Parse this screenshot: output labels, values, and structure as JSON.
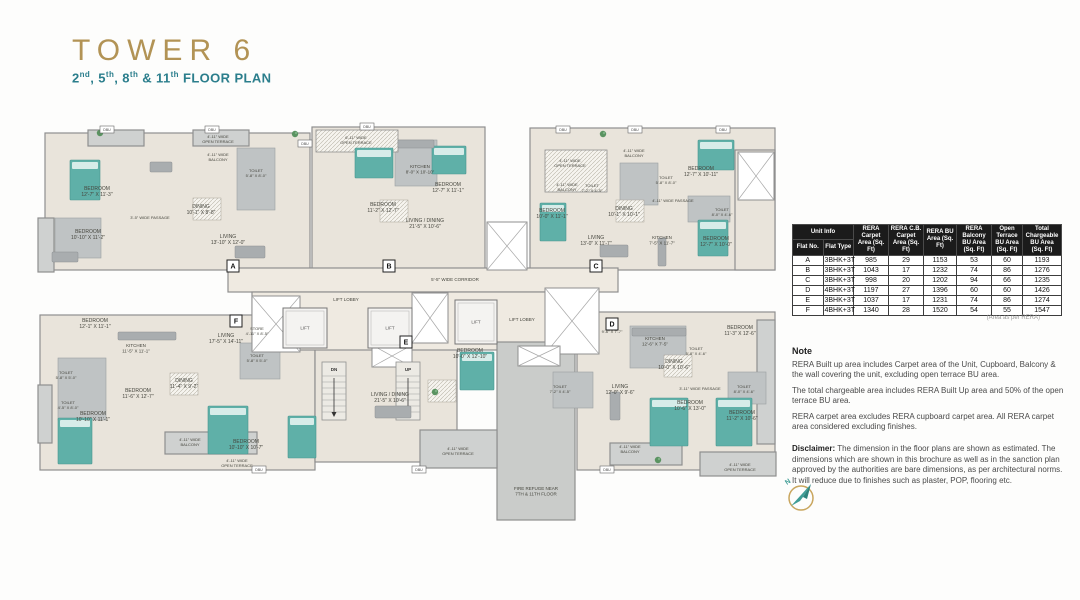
{
  "header": {
    "title": "TOWER 6",
    "subtitle_parts": [
      [
        "2",
        "nd"
      ],
      [
        ", 5",
        "th"
      ],
      [
        ", 8",
        "th"
      ],
      [
        " & 11",
        "th"
      ],
      [
        " FLOOR PLAN",
        ""
      ]
    ],
    "title_color": "#b29355",
    "subtitle_color": "#2b7e8c"
  },
  "table": {
    "group_header": "Unit Info",
    "header_bg": "#1b1b1b",
    "columns": [
      "Flat No.",
      "Flat Type",
      "RERA Carpet Area (Sq. Ft)",
      "RERA C.B. Carpet Area (Sq. Ft)",
      "RERA BU Area (Sq. Ft)",
      "RERA Balcony BU Area (Sq. Ft)",
      "Open Terrace BU Area (Sq. Ft)",
      "Total Chargeable BU Area (Sq. Ft)"
    ],
    "col_widths": [
      16,
      42,
      32,
      32,
      30,
      32,
      28,
      36
    ],
    "rows": [
      [
        "A",
        "3BHK+3T",
        "985",
        "29",
        "1153",
        "53",
        "60",
        "1193"
      ],
      [
        "B",
        "3BHK+3T",
        "1043",
        "17",
        "1232",
        "74",
        "86",
        "1276"
      ],
      [
        "C",
        "3BHK+3T",
        "998",
        "20",
        "1202",
        "94",
        "66",
        "1235"
      ],
      [
        "D",
        "4BHK+3T",
        "1197",
        "27",
        "1396",
        "60",
        "60",
        "1426"
      ],
      [
        "E",
        "3BHK+3T",
        "1037",
        "17",
        "1231",
        "74",
        "86",
        "1274"
      ],
      [
        "F",
        "4BHK+3T",
        "1340",
        "28",
        "1520",
        "54",
        "55",
        "1547"
      ]
    ],
    "caption": "(Area as per RERA)"
  },
  "notes": {
    "heading": "Note",
    "paragraphs": [
      "RERA Built up area includes Carpet area of the Unit, Cupboard, Balcony & the wall covering the unit, excluding open terrace BU area.",
      "The total chargeable area includes RERA Built Up area and 50% of the open terrace BU area.",
      "RERA carpet area excludes RERA cupboard carpet area. All RERA carpet area considered excluding finishes."
    ],
    "disclaimer_label": "Disclaimer:",
    "disclaimer_text": " The dimension in the floor plans are shown as estimated. The dimensions which are shown in this brochure as well as in the sanction plan approved by the authorities are bare dimensions, as per architectural norms. It will reduce due to finishes such as plaster, POP, flooring etc."
  },
  "compass": {
    "label": "N",
    "ring_color": "#c9a65e",
    "arrow_color": "#3f9d96"
  },
  "plan": {
    "colors": {
      "floor": "#e9e4db",
      "floor2": "#efeae1",
      "gray": "#cfd1d0",
      "tile": "#bfc3c4",
      "refuge": "#caccca",
      "wall": "#8f8f8f",
      "bed": "#5fb0a8",
      "pillow": "#d7ece9",
      "furn": "#a9adaf",
      "label": "#45453d",
      "plant": "#5a9361"
    },
    "blocks": [
      [
        45,
        133,
        265,
        137,
        "floor"
      ],
      [
        312,
        127,
        173,
        143,
        "floor"
      ],
      [
        530,
        128,
        245,
        142,
        "floor"
      ],
      [
        735,
        150,
        40,
        120,
        "floor"
      ],
      [
        40,
        315,
        275,
        155,
        "floor"
      ],
      [
        315,
        330,
        142,
        132,
        "floor"
      ],
      [
        577,
        312,
        198,
        158,
        "floor"
      ],
      [
        228,
        268,
        390,
        24,
        "floor2"
      ],
      [
        252,
        292,
        330,
        58,
        "floor2"
      ],
      [
        497,
        342,
        78,
        178,
        "refuge"
      ],
      [
        700,
        452,
        76,
        24,
        "gray"
      ],
      [
        610,
        443,
        72,
        22,
        "gray"
      ],
      [
        165,
        432,
        92,
        22,
        "gray"
      ],
      [
        420,
        430,
        77,
        38,
        "gray"
      ],
      [
        38,
        218,
        16,
        54,
        "gray"
      ],
      [
        38,
        385,
        14,
        58,
        "gray"
      ],
      [
        88,
        130,
        56,
        16,
        "gray"
      ],
      [
        193,
        130,
        56,
        16,
        "gray"
      ],
      [
        757,
        320,
        18,
        124,
        "gray"
      ]
    ],
    "tiles": [
      [
        237,
        148,
        38,
        62
      ],
      [
        55,
        218,
        46,
        40
      ],
      [
        395,
        140,
        42,
        46
      ],
      [
        620,
        163,
        38,
        42
      ],
      [
        688,
        196,
        42,
        26
      ],
      [
        58,
        358,
        48,
        62
      ],
      [
        240,
        343,
        40,
        36
      ],
      [
        630,
        326,
        56,
        42
      ],
      [
        728,
        372,
        38,
        32
      ],
      [
        553,
        372,
        40,
        36
      ]
    ],
    "hatches": [
      [
        316,
        130,
        82,
        22
      ],
      [
        545,
        150,
        62,
        42
      ]
    ],
    "shafts": [
      [
        487,
        222,
        40,
        48
      ],
      [
        545,
        288,
        54,
        66
      ],
      [
        252,
        296,
        48,
        56
      ],
      [
        412,
        293,
        36,
        50
      ],
      [
        372,
        345,
        40,
        22
      ],
      [
        518,
        346,
        42,
        20
      ],
      [
        738,
        152,
        36,
        48
      ]
    ],
    "lifts": [
      [
        283,
        308,
        44,
        40
      ],
      [
        368,
        308,
        44,
        40
      ],
      [
        455,
        300,
        42,
        44
      ]
    ],
    "lift_label": "LIFT",
    "stairs": [
      {
        "x": 322,
        "y": 362,
        "w": 24,
        "h": 58,
        "label": "DN"
      },
      {
        "x": 396,
        "y": 362,
        "w": 24,
        "h": 58,
        "label": "UP"
      }
    ],
    "beds": [
      [
        70,
        160,
        30,
        40
      ],
      [
        355,
        148,
        38,
        30
      ],
      [
        432,
        146,
        34,
        28
      ],
      [
        698,
        140,
        36,
        30
      ],
      [
        540,
        203,
        26,
        38
      ],
      [
        698,
        220,
        30,
        36
      ],
      [
        58,
        418,
        34,
        46
      ],
      [
        208,
        406,
        40,
        48
      ],
      [
        288,
        416,
        28,
        42
      ],
      [
        460,
        352,
        34,
        38
      ],
      [
        650,
        398,
        38,
        48
      ],
      [
        716,
        398,
        36,
        48
      ]
    ],
    "furn": [
      [
        150,
        162,
        22,
        10
      ],
      [
        118,
        332,
        58,
        8
      ],
      [
        398,
        140,
        36,
        8
      ],
      [
        632,
        328,
        54,
        8
      ],
      [
        658,
        238,
        8,
        28
      ],
      [
        235,
        246,
        30,
        12
      ],
      [
        600,
        245,
        28,
        12
      ],
      [
        610,
        392,
        10,
        28
      ],
      [
        375,
        406,
        36,
        12
      ],
      [
        52,
        252,
        26,
        10
      ]
    ],
    "dining": [
      [
        193,
        198,
        28,
        22
      ],
      [
        616,
        200,
        28,
        22
      ],
      [
        170,
        373,
        28,
        22
      ],
      [
        380,
        200,
        28,
        22
      ],
      [
        428,
        380,
        28,
        22
      ],
      [
        664,
        355,
        28,
        22
      ]
    ],
    "plants": [
      [
        295,
        134
      ],
      [
        603,
        134
      ],
      [
        658,
        460
      ],
      [
        100,
        133
      ],
      [
        435,
        392
      ]
    ],
    "dbu_label": "DBU",
    "dbu": [
      [
        100,
        126
      ],
      [
        205,
        126
      ],
      [
        298,
        140
      ],
      [
        360,
        123
      ],
      [
        556,
        126
      ],
      [
        628,
        126
      ],
      [
        716,
        126
      ],
      [
        252,
        466
      ],
      [
        412,
        466
      ],
      [
        600,
        466
      ]
    ],
    "badges": [
      [
        233,
        266,
        "A"
      ],
      [
        389,
        266,
        "B"
      ],
      [
        596,
        266,
        "C"
      ],
      [
        612,
        324,
        "D"
      ],
      [
        406,
        342,
        "E"
      ],
      [
        236,
        321,
        "F"
      ]
    ],
    "labels": [
      [
        97,
        190,
        "BEDROOM|12'-7\" X 11'-3\""
      ],
      [
        88,
        233,
        "BEDROOM|10'-10\" X 11'-2\""
      ],
      [
        256,
        172,
        "TOILET|5'-8\" X 8'-0\"",
        4
      ],
      [
        150,
        219,
        "3'-5\" WIDE PASSAGE",
        4
      ],
      [
        201,
        208,
        "DINING|10'-1\" X 8'-8\""
      ],
      [
        228,
        238,
        "LIVING|13'-10\" X 12'-0\""
      ],
      [
        218,
        138,
        "4'-11\" WIDE|OPEN TERRACE",
        4
      ],
      [
        218,
        156,
        "4'-11\" WIDE|BALCONY",
        4
      ],
      [
        383,
        206,
        "BEDROOM|11'-2\" X 12'-7\""
      ],
      [
        448,
        186,
        "BEDROOM|12'-7\" X 11'-1\""
      ],
      [
        356,
        139,
        "6'-11\" WIDE|OPEN TERRACE",
        4
      ],
      [
        420,
        168,
        "KITCHEN|8'-0\" X 10'-10\"",
        4.5
      ],
      [
        425,
        222,
        "LIVING / DINING|21'-5\" X 10'-6\""
      ],
      [
        455,
        281,
        "5'-5\" WIDE CORRIDOR",
        4.5
      ],
      [
        570,
        162,
        "4'-11\" WIDE|OPEN TERRACE",
        4
      ],
      [
        567,
        186,
        "4'-11\" WIDE|BALCONY",
        4
      ],
      [
        552,
        212,
        "BEDROOM|10'-0\" X 11'-1\""
      ],
      [
        592,
        187,
        "TOILET|7'-2\" X 4'-5\"",
        4
      ],
      [
        624,
        210,
        "DINING|10'-1\" X 10'-1\""
      ],
      [
        634,
        152,
        "4'-11\" WIDE|BALCONY",
        4
      ],
      [
        666,
        179,
        "TOILET|5'-8\" X 8'-0\"",
        4
      ],
      [
        701,
        170,
        "BEDROOM|12'-7\" X 10'-11\""
      ],
      [
        673,
        202,
        "4'-11\" WIDE PASSAGE",
        4
      ],
      [
        722,
        211,
        "TOILET|8'-0\" X 4'-6\"",
        4
      ],
      [
        716,
        240,
        "BEDROOM|12'-7\" X 10'-0\""
      ],
      [
        596,
        239,
        "LIVING|13'-0\" X 11'-7\""
      ],
      [
        662,
        239,
        "KITCHEN|7'-5\" X 11'-7\"",
        4.5
      ],
      [
        346,
        301,
        "LIFT LOBBY",
        4.5
      ],
      [
        522,
        321,
        "LIFT LOBBY",
        4.5
      ],
      [
        95,
        322,
        "BEDROOM|12'-1\" X 11'-1\""
      ],
      [
        136,
        347,
        "KITCHEN|11'-5\" X 11'-1\"",
        4.5
      ],
      [
        226,
        337,
        "LIVING|17'-5\" X 14'-11\""
      ],
      [
        257,
        330,
        "STORE|4'-11\" X 8'-5\"",
        4
      ],
      [
        66,
        374,
        "TOILET|5'-8\" X 5'-0\"",
        4
      ],
      [
        68,
        404,
        "TOILET|4'-5\" X 8'-0\"",
        4
      ],
      [
        257,
        357,
        "TOILET|5'-8\" X 5'-0\"",
        4
      ],
      [
        184,
        382,
        "DINING|11'-4\" X 9'-2\""
      ],
      [
        138,
        392,
        "BEDROOM|11'-6\" X 12'-7\""
      ],
      [
        93,
        415,
        "BEDROOM|10'-10\" X 11'-1\""
      ],
      [
        246,
        443,
        "BEDROOM|10'-10\" X 10'-7\""
      ],
      [
        190,
        441,
        "4'-11\" WIDE|BALCONY",
        4
      ],
      [
        237,
        462,
        "4'-11\" WIDE|OPEN TERRACE",
        4
      ],
      [
        470,
        352,
        "BEDROOM|10'-0\" X 12'-10\""
      ],
      [
        390,
        396,
        "LIVING / DINING|21'-5\" X 10'-6\""
      ],
      [
        458,
        450,
        "4'-11\" WIDE|OPEN TERRACE",
        4
      ],
      [
        560,
        388,
        "TOILET|7'-2\" X 4'-5\"",
        4
      ],
      [
        655,
        340,
        "KITCHEN|12'-6\" X 7'-5\"",
        4.5
      ],
      [
        612,
        333,
        "9'-6\" X 7'-7\"",
        4
      ],
      [
        740,
        329,
        "BEDROOM|11'-3\" X 12'-6\""
      ],
      [
        696,
        350,
        "TOILET|5'-8\" X 4'-6\"",
        4
      ],
      [
        674,
        363,
        "DINING|10'-0\" X 10'-6\""
      ],
      [
        620,
        388,
        "LIVING|12'-0\" X 9'-6\""
      ],
      [
        700,
        390,
        "3'-11\" WIDE PASSAGE",
        4
      ],
      [
        744,
        388,
        "TOILET|8'-0\" X 4'-6\"",
        4
      ],
      [
        690,
        404,
        "BEDROOM|10'-6\" X 13'-0\""
      ],
      [
        742,
        414,
        "BEDROOM|11'-2\" X 10'-6\""
      ],
      [
        630,
        448,
        "4'-11\" WIDE|BALCONY",
        4
      ],
      [
        740,
        466,
        "4'-11\" WIDE|OPEN TERRACE",
        4
      ],
      [
        536,
        490,
        "FIRE REFUGE NEAR|7TH & 11TH FLOOR",
        4.5
      ]
    ]
  }
}
